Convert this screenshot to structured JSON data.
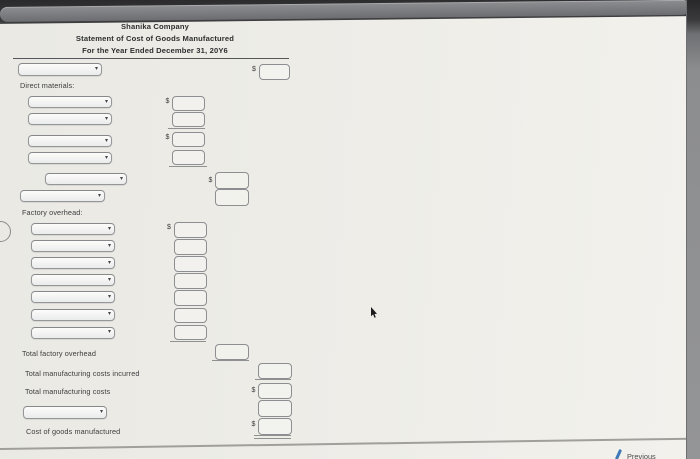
{
  "header": {
    "company": "Shanika Company",
    "statement": "Statement of Cost of Goods Manufactured",
    "period": "For the Year Ended December 31, 20Y6"
  },
  "currency_symbol": "$",
  "section_labels": {
    "direct_materials": "Direct materials:",
    "factory_overhead": "Factory overhead:"
  },
  "row_labels": {
    "total_factory_overhead": "Total factory overhead",
    "total_manufacturing_costs_incurred": "Total manufacturing costs incurred",
    "total_manufacturing_costs": "Total manufacturing costs",
    "cost_of_goods_manufactured": "Cost of goods manufactured"
  },
  "nav": {
    "previous_label": "Previous"
  },
  "form_values": {
    "title_row": {
      "select": "",
      "amount": ""
    },
    "direct_materials": {
      "selects": [
        "",
        "",
        "",
        "",
        "",
        ""
      ],
      "col1_amounts": [
        "",
        "",
        "",
        ""
      ],
      "col2_amounts": [
        "",
        ""
      ]
    },
    "factory_overhead": {
      "selects": [
        "",
        "",
        "",
        "",
        "",
        "",
        ""
      ],
      "amounts": [
        "",
        "",
        "",
        "",
        "",
        "",
        ""
      ]
    },
    "totals": {
      "total_factory_overhead_amount": "",
      "total_manufacturing_costs_incurred_amount": "",
      "total_manufacturing_costs_amount": "",
      "final_select": "",
      "final_amount": "",
      "cost_of_goods_manufactured_amount": ""
    }
  }
}
